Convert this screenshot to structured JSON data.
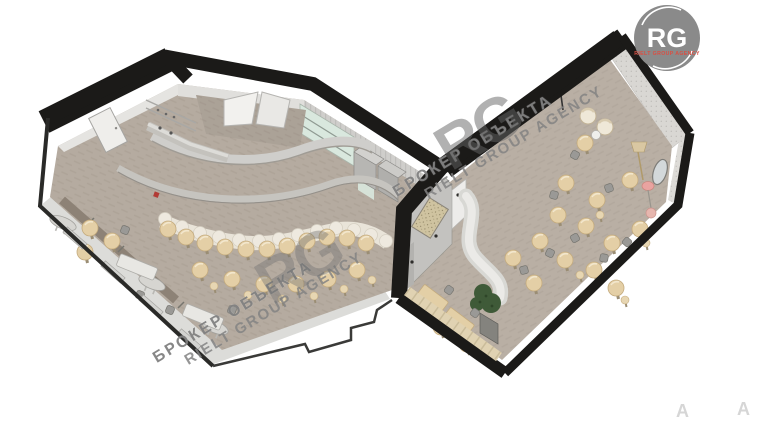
{
  "watermark": {
    "brand_line1": "БРОКЕР ОБЪЕКТА",
    "brand_line2": "RIELT GROUP AGENCY",
    "monogram": "RG",
    "faint_letter": "A"
  },
  "logo": {
    "monogram": "RG",
    "subtitle": "RIELT GROUP AGENCY"
  },
  "colors": {
    "wall-black": "#1b1a18",
    "wall-light": "#e5e4e1",
    "wall-mid": "#cfcecb",
    "floor": "#b5aba0",
    "walkway": "#dcdcd9",
    "banquette": "#e9e4d9",
    "tabletop": "#e4cfa6",
    "stool": "#e7d6b2",
    "bench": "#8d8276",
    "cushion": "#e0d2b2",
    "mint": "#d9e8de",
    "plant": "#3f5a38",
    "pink": "#e9a3a0",
    "gray-chair": "#9a9996",
    "logo-gray": "#8a8a8a",
    "logo-red": "#d94f43"
  }
}
